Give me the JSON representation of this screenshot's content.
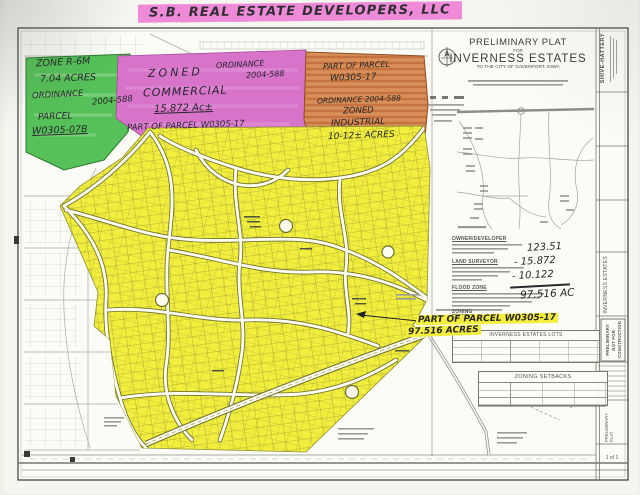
{
  "title": {
    "text": "S.B. REAL ESTATE DEVELOPERS, LLC"
  },
  "zones": {
    "green": {
      "lines": [
        "ZONE R-6M",
        "7.04 ACRES",
        "ORDINANCE",
        "2004-588",
        "PARCEL",
        "W0305-07B"
      ]
    },
    "pink": {
      "lines": [
        "ZONED",
        "ORDINANCE",
        "2004-588",
        "COMMERCIAL",
        "15.872 Ac±",
        "PART OF PARCEL W0305-17"
      ]
    },
    "orange": {
      "lines": [
        "PART OF PARCEL",
        "W0305-17",
        "ORDINANCE 2004-588",
        "ZONED",
        "INDUSTRIAL",
        "10-12± ACRES"
      ]
    }
  },
  "panel": {
    "plat_title": {
      "line1": "PRELIMINARY PLAT",
      "line2": "FOR",
      "line3": "INVERNESS ESTATES",
      "line4": "TO THE CITY OF DAVENPORT, IOWA"
    },
    "sections": {
      "owner": "OWNER/DEVELOPER",
      "surveyor": "LAND SURVEYOR",
      "flood": "FLOOD ZONE",
      "zoning": "ZONING"
    },
    "calc": {
      "line1": "123.51",
      "line2": "- 15.872",
      "line3": "- 10.122",
      "total": "97.516 AC"
    },
    "note": {
      "line1": "PART OF PARCEL W0305-17",
      "line2": "97.516 ACRES"
    },
    "lots_table_title": "INVERNESS ESTATES LOTS",
    "setbacks_table_title": "ZONING SETBACKS"
  },
  "sidebar": {
    "firm": "SHIVE-HATTERY",
    "project": "INVERNESS ESTATES",
    "stamp_line1": "PRELIMINARY",
    "stamp_line2": "NOT FOR",
    "stamp_line3": "CONSTRUCTION",
    "sheet_type": "PRELIMINARY PLAT",
    "sheet_no": "1 of 1"
  },
  "colors": {
    "highlight_pink": "#ef8ad9",
    "zone_green": "#55c158",
    "zone_pink": "#d873ca",
    "zone_orange": "#d88f58",
    "zone_yellow": "#f1ee3d",
    "ink": "#26262b"
  }
}
